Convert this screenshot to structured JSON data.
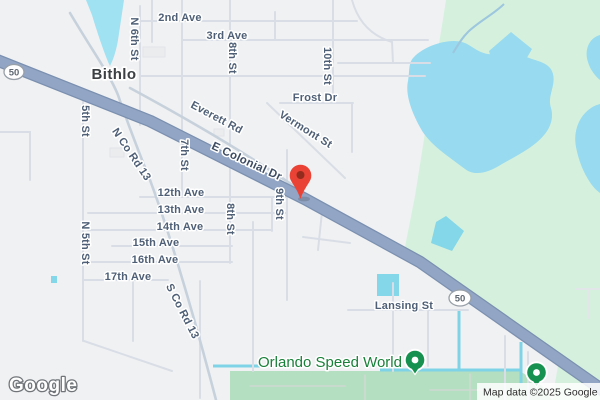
{
  "map": {
    "town": "Bithlo",
    "route": "50",
    "poi": "Orlando Speed World",
    "streets": [
      {
        "name": "2nd Ave"
      },
      {
        "name": "3rd Ave"
      },
      {
        "name": "N 6th St"
      },
      {
        "name": "8th St"
      },
      {
        "name": "10th St"
      },
      {
        "name": "Frost Dr"
      },
      {
        "name": "Vermont St"
      },
      {
        "name": "Everett Rd"
      },
      {
        "name": "E Colonial Dr"
      },
      {
        "name": "5th St"
      },
      {
        "name": "7th St"
      },
      {
        "name": "N Co Rd 13"
      },
      {
        "name": "9th St"
      },
      {
        "name": "12th Ave"
      },
      {
        "name": "13th Ave"
      },
      {
        "name": "14th Ave"
      },
      {
        "name": "15th Ave"
      },
      {
        "name": "16th Ave"
      },
      {
        "name": "17th Ave"
      },
      {
        "name": "8th St"
      },
      {
        "name": "N 5th St"
      },
      {
        "name": "S Co Rd 13"
      },
      {
        "name": "Lansing St"
      }
    ],
    "watermark": "Google",
    "attribution": "Map data ©2025 Google",
    "colors": {
      "land": "#f0f1f3",
      "nature_green": "#d5f1dd",
      "park_green": "#b4dfc0",
      "water_blue": "#98daef",
      "canal_cyan": "#7fd3e6",
      "highway_blue": "#92a5c4",
      "pin_red": "#ea4335",
      "poi_marker_green": "#17914f",
      "poi_text_green": "#188038"
    }
  }
}
